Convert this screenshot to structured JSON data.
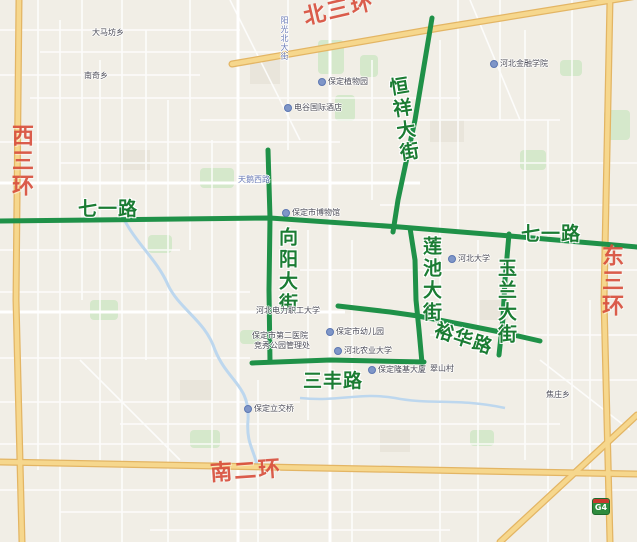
{
  "map": {
    "ring_road_labels": {
      "north": "北三环",
      "west": "西三环",
      "south": "南二环",
      "east": "东三环"
    },
    "highlighted_road_labels": {
      "qiyilu_west": "七一路",
      "qiyilu_east": "七一路",
      "xiangyang": "向阳大街",
      "hengxiang": "恒祥大街",
      "lianchi": "莲池大街",
      "yulan": "玉兰大街",
      "sanfeng": "三丰路",
      "yuhua": "裕华路"
    },
    "minor_road_labels": [
      {
        "text": "天鹅西路"
      },
      {
        "text": "阳光北大街"
      }
    ],
    "pois": [
      {
        "text": "大马坊乡"
      },
      {
        "text": "南奇乡"
      },
      {
        "text": "保定植物园"
      },
      {
        "text": "电谷国际酒店"
      },
      {
        "text": "河北金融学院"
      },
      {
        "text": "保定市博物馆"
      },
      {
        "text": "河北大学"
      },
      {
        "text": "河北农业大学"
      },
      {
        "text": "保定市幼儿园"
      },
      {
        "text": "河北电力职工大学"
      },
      {
        "text": "保定隆基大厦"
      },
      {
        "text": "保定市第二医院"
      },
      {
        "text": "竞秀公园管理处"
      },
      {
        "text": "保定立交桥"
      },
      {
        "text": "焦庄乡"
      },
      {
        "text": "翠山村"
      }
    ],
    "expressway_badge": "G4",
    "colors": {
      "highlight_road_green": "#1f9148",
      "highlight_label_green": "#1b7c33",
      "ring_label_red": "#d9503e",
      "ring_road_yellow": "#f6d78d",
      "background": "#f1eee6",
      "water": "#bdd7ee",
      "park": "#d5e8cb"
    }
  }
}
